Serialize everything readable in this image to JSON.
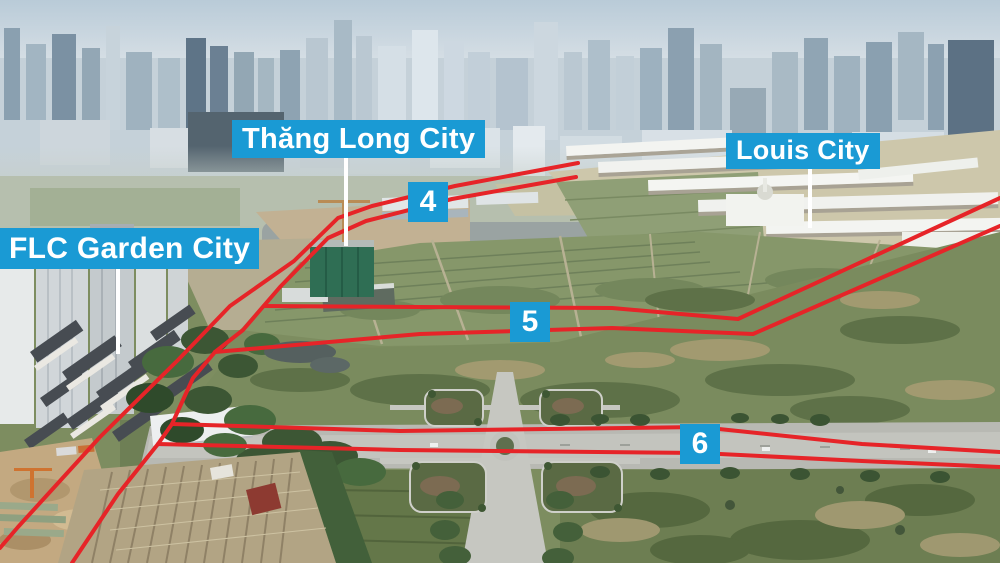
{
  "annotations": {
    "labels": [
      {
        "id": "thang-long-city",
        "text": "Thăng Long City"
      },
      {
        "id": "louis-city",
        "text": "Louis City"
      },
      {
        "id": "flc-garden-city",
        "text": "FLC Garden City"
      }
    ],
    "markers": [
      {
        "value": "4"
      },
      {
        "value": "5"
      },
      {
        "value": "6"
      }
    ],
    "colors": {
      "label_background": "#1a9ad4",
      "label_text": "#ffffff",
      "route_line": "#e62428",
      "callout_line": "#ffffff"
    }
  },
  "overlay": {
    "routes": [
      {
        "name": "route-edge-west",
        "points": "578,163 455,186 430,192 372,206 338,218 294,261 230,306 178,360 100,437 18,527 0,548",
        "width": 4
      },
      {
        "name": "route-edge-east",
        "points": "576,177 452,199 366,221 328,238 280,287 243,330 215,352 193,378 172,424 158,444 118,494 72,563",
        "width": 4
      },
      {
        "name": "route-5-north-edge",
        "points": "264,306 420,307 612,308 738,319 1000,198",
        "width": 4
      },
      {
        "name": "route-5-south-edge",
        "points": "215,352 420,334 612,328 753,334 1000,226",
        "width": 4
      },
      {
        "name": "route-6-north-edge",
        "points": "172,424 400,431 700,427 862,444 1000,452",
        "width": 4
      },
      {
        "name": "route-6-south-edge",
        "points": "158,444 400,450 700,453 862,461 1000,467",
        "width": 4
      }
    ],
    "callouts": [
      {
        "name": "callout-thang-long-city",
        "x1": 346,
        "y1": 157,
        "x2": 346,
        "y2": 246
      },
      {
        "name": "callout-louis-city",
        "x1": 810,
        "y1": 165,
        "x2": 810,
        "y2": 228
      },
      {
        "name": "callout-flc-garden-city",
        "x1": 118,
        "y1": 268,
        "x2": 118,
        "y2": 354
      }
    ]
  }
}
